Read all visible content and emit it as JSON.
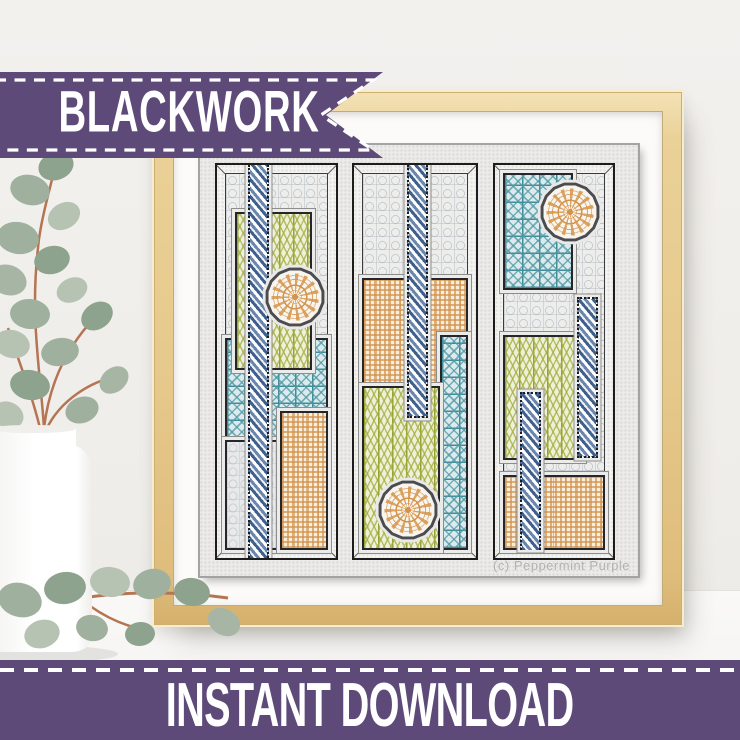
{
  "banners": {
    "top": {
      "label": "BLACKWORK"
    },
    "bottom": {
      "label": "INSTANT DOWNLOAD"
    }
  },
  "artwork": {
    "watermark": "(c) Peppermint Purple",
    "panel_count": 3,
    "subject": "framed blackwork embroidery sampler with three vertical panels",
    "motifs": [
      "braided navy bands",
      "orange medallions",
      "teal lattice blocks",
      "olive lattice blocks",
      "orange basketweave blocks",
      "grey lattice background"
    ]
  },
  "colors": {
    "banner_purple": "#5e4a78",
    "banner_text": "#ffffff",
    "frame_wood": "#e6c98c",
    "frame_wood_light": "#f4e2b8",
    "frame_wood_dark": "#d5b06c",
    "mat_white": "#fcfbf9",
    "fabric_grey": "#ecebe9",
    "navy": "#3f5f8c",
    "navy_light": "#6b86ad",
    "teal": "#4e98a4",
    "teal_deep": "#3f8b97",
    "olive": "#a3ae3e",
    "olive_deep": "#96a136",
    "orange": "#d2934d",
    "orange_deep": "#c47f35",
    "outline": "#26262a",
    "watermark_grey": "#b3b2af",
    "wall": "#f0eeeb",
    "surface": "#f8f7f5",
    "leaf_a": "#9fb09e",
    "leaf_b": "#8ea38d",
    "leaf_c": "#b6c3b3",
    "stem": "#b57452"
  }
}
